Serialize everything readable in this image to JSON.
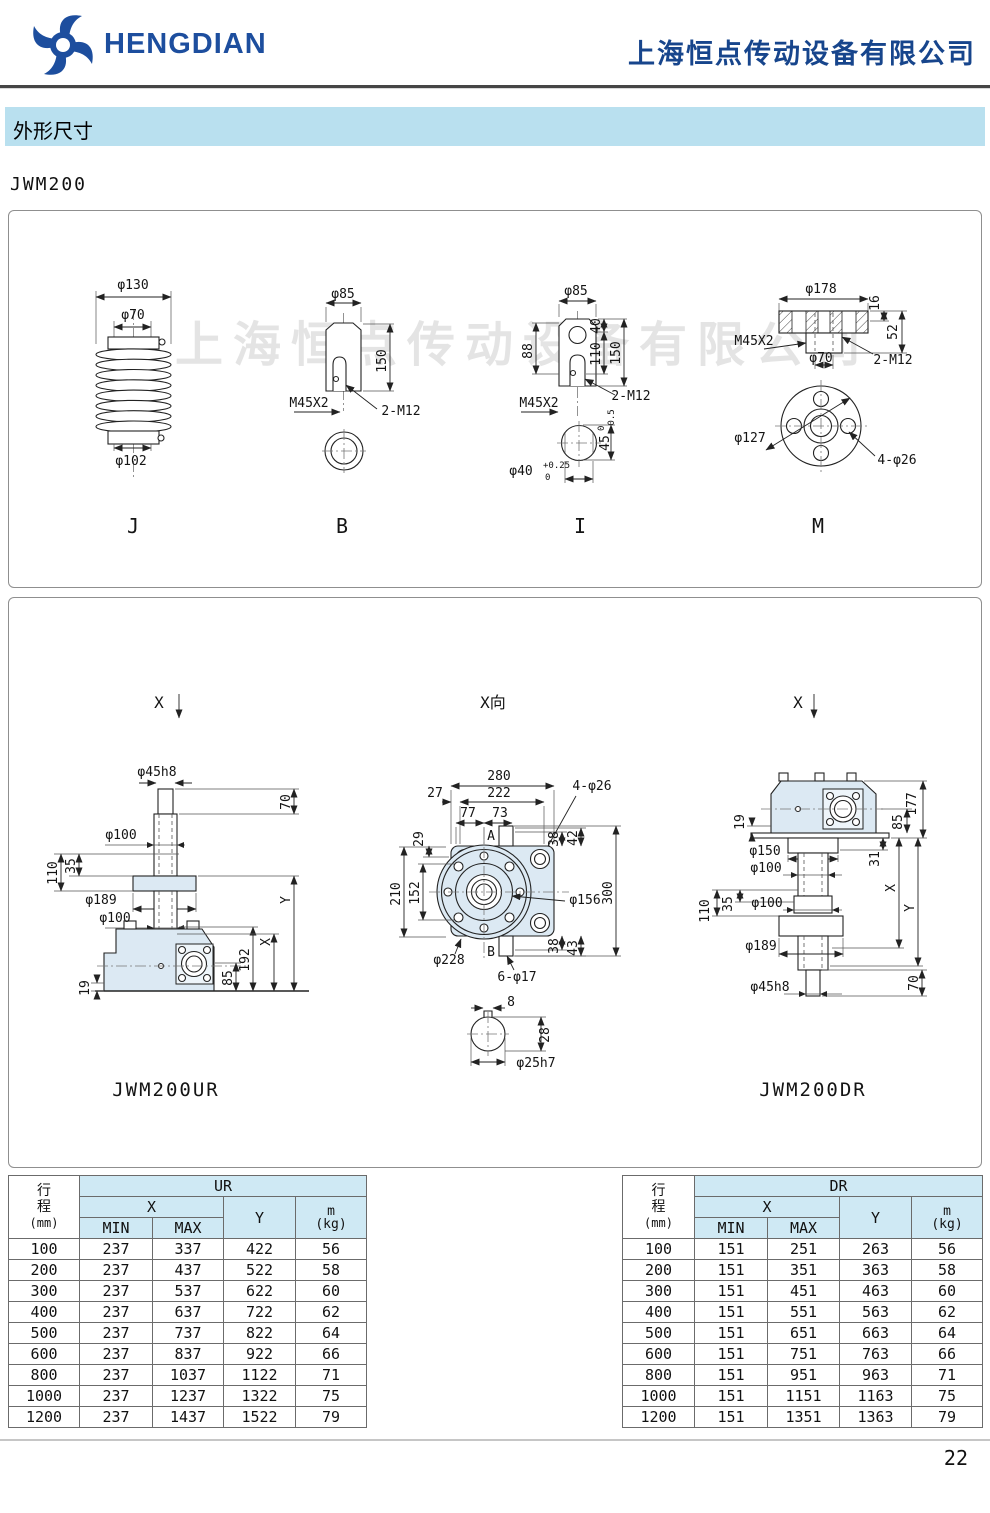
{
  "header": {
    "brand": "HENGDIAN",
    "company": "上海恒点传动设备有限公司"
  },
  "section_title": "外形尺寸",
  "model": "JWM200",
  "watermark": "上海恒点传动设备有限公司",
  "page_number": "22",
  "top_views": {
    "j": {
      "label": "J",
      "d130": "φ130",
      "d70": "φ70",
      "d102": "φ102"
    },
    "b": {
      "label": "B",
      "d85": "φ85",
      "h150": "150",
      "thread": "M45X2",
      "tap": "2-M12"
    },
    "i": {
      "label": "I",
      "d85": "φ85",
      "h88": "88",
      "h40": "40",
      "h110": "110",
      "h150": "150",
      "thread": "M45X2",
      "tap": "2-M12",
      "bore": "φ40",
      "bore_sup": "+0.25",
      "bore_sub": "0",
      "flat": "45",
      "flat_sup": "0",
      "flat_sub": "-0.5"
    },
    "m": {
      "label": "M",
      "d178": "φ178",
      "t16": "16",
      "t52": "52",
      "thread": "M45X2",
      "d70": "φ70",
      "tap": "2-M12",
      "bc": "φ127",
      "holes": "4-φ26"
    }
  },
  "assembly": {
    "section_arrow": "X",
    "xview_title": "X向",
    "ur": {
      "caption": "JWM200UR",
      "screw": "φ45h8",
      "h70": "70",
      "d100a": "φ100",
      "h110": "110",
      "h35": "35",
      "d189": "φ189",
      "d100b": "φ100",
      "dimy": "Y",
      "dimx": "X",
      "h192": "192",
      "h85": "85",
      "h19": "19"
    },
    "xview": {
      "w280": "280",
      "w222": "222",
      "w27": "27",
      "holes4": "4-φ26",
      "w77": "77",
      "w73": "73",
      "h29": "29",
      "a": "A",
      "t38": "38",
      "t42": "42",
      "h210": "210",
      "h152": "152",
      "d156": "φ156",
      "h300": "300",
      "d228": "φ228",
      "b": "B",
      "b38": "38",
      "b43": "43",
      "holes6": "6-φ17",
      "w8": "8",
      "h28": "28",
      "shaft": "φ25h7"
    },
    "dr": {
      "caption": "JWM200DR",
      "h19": "19",
      "h177": "177",
      "h85": "85",
      "d150": "φ150",
      "h31": "31",
      "d100a": "φ100",
      "dimx": "X",
      "dimy": "Y",
      "h110": "110",
      "h35": "35",
      "d100b": "φ100",
      "d189": "φ189",
      "h70": "70",
      "screw": "φ45h8"
    }
  },
  "tables": {
    "left": {
      "col_stroke_1": "行",
      "col_stroke_2": "程",
      "col_stroke_unit": "(mm)",
      "group": "UR",
      "col_x": "X",
      "col_min": "MIN",
      "col_max": "MAX",
      "col_y": "Y",
      "col_m_1": "m",
      "col_m_2": "(kg)",
      "rows": [
        [
          "100",
          "237",
          "337",
          "422",
          "56"
        ],
        [
          "200",
          "237",
          "437",
          "522",
          "58"
        ],
        [
          "300",
          "237",
          "537",
          "622",
          "60"
        ],
        [
          "400",
          "237",
          "637",
          "722",
          "62"
        ],
        [
          "500",
          "237",
          "737",
          "822",
          "64"
        ],
        [
          "600",
          "237",
          "837",
          "922",
          "66"
        ],
        [
          "800",
          "237",
          "1037",
          "1122",
          "71"
        ],
        [
          "1000",
          "237",
          "1237",
          "1322",
          "75"
        ],
        [
          "1200",
          "237",
          "1437",
          "1522",
          "79"
        ]
      ]
    },
    "right": {
      "col_stroke_1": "行",
      "col_stroke_2": "程",
      "col_stroke_unit": "(mm)",
      "group": "DR",
      "col_x": "X",
      "col_min": "MIN",
      "col_max": "MAX",
      "col_y": "Y",
      "col_m_1": "m",
      "col_m_2": "(kg)",
      "rows": [
        [
          "100",
          "151",
          "251",
          "263",
          "56"
        ],
        [
          "200",
          "151",
          "351",
          "363",
          "58"
        ],
        [
          "300",
          "151",
          "451",
          "463",
          "60"
        ],
        [
          "400",
          "151",
          "551",
          "563",
          "62"
        ],
        [
          "500",
          "151",
          "651",
          "663",
          "64"
        ],
        [
          "600",
          "151",
          "751",
          "763",
          "66"
        ],
        [
          "800",
          "151",
          "951",
          "963",
          "71"
        ],
        [
          "1000",
          "151",
          "1151",
          "1163",
          "75"
        ],
        [
          "1200",
          "151",
          "1351",
          "1363",
          "79"
        ]
      ]
    }
  }
}
